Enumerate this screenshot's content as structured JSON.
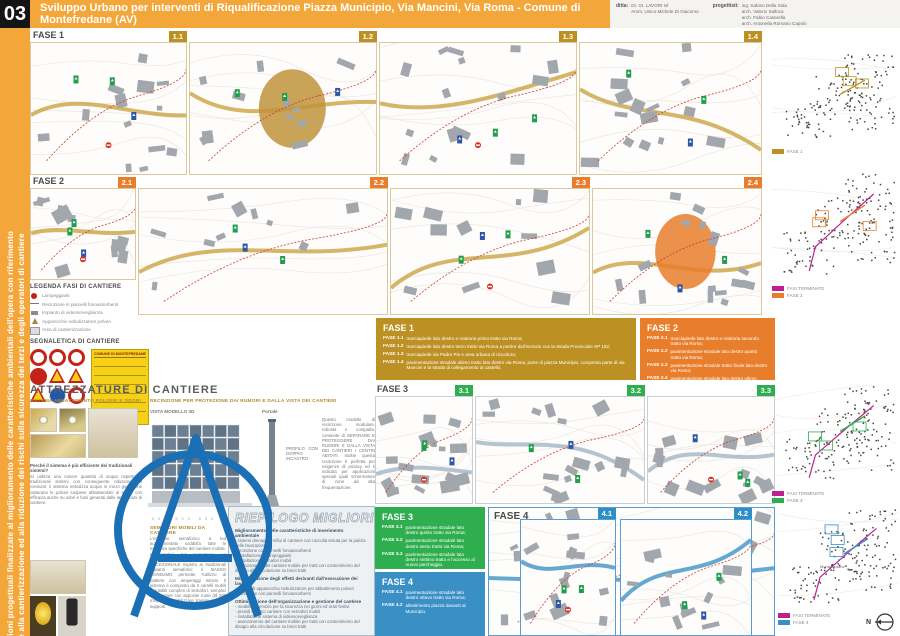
{
  "header": {
    "sheet_number": "03",
    "title": "Sviluppo Urbano per interventi di Riqualificazione Piazza Municipio, Via Mancini, Via Roma - Comune di Montefredane (AV)",
    "ditta_label": "ditta:",
    "ditta_lines": [
      "DI. GI. LAVORI srl",
      "Amm. Unico Michele Di Giacomo"
    ],
    "progettisti_label": "progettisti:",
    "progettisti_lines": [
      "ing. Sabino Della Sala",
      "arch. Valerio Salloca",
      "arch. Fabio Casarella",
      "arch. Antonella Romano Capolo"
    ]
  },
  "sidebar": {
    "line1": "Soluzioni progettuali finalizzate al miglioramento delle caratteristiche ambientali dell'opera con riferimento",
    "line2": "anche alla cantierizzazione ed alla riduzione dei rischi sulla sicurezza dei terzi e degli operatori di cantiere"
  },
  "rows": {
    "fase1": {
      "label": "FASE 1",
      "badges": [
        "1.1",
        "1.2",
        "1.3",
        "1.4"
      ]
    },
    "fase2": {
      "label": "FASE 2",
      "badges": [
        "2.1",
        "2.2",
        "2.3",
        "2.4"
      ]
    },
    "fase3": {
      "label": "FASE 3",
      "badges": [
        "3.1",
        "3.2",
        "3.3"
      ]
    },
    "fase4": {
      "label": "FASE 4",
      "badges": [
        "4.1",
        "4.2"
      ]
    }
  },
  "legend": {
    "title": "LEGENDA FASI DI CANTIERE",
    "items": [
      {
        "icon": "lamp",
        "label": "Lampeggianti"
      },
      {
        "icon": "fence",
        "label": "Recinzione in pannelli fonoassorbenti"
      },
      {
        "icon": "camera",
        "label": "Impianto di videosorveglianza"
      },
      {
        "icon": "fog",
        "label": "Apparecchio nebulizzatore polveri"
      },
      {
        "icon": "area",
        "label": "Area di cantierizzazione"
      }
    ],
    "segnaletica_title": "SEGNALETICA DI CANTIERE",
    "sign_board_title": "COMUNE DI MONTEFREDANE"
  },
  "fase_boxes": {
    "fase1": {
      "title": "FASE 1",
      "items": [
        {
          "code": "FASE 1.1",
          "text": "marciapiede lato destro e rotatoria primo tratto via Roma;"
        },
        {
          "code": "FASE 1.2",
          "text": "marciapiede lato destro terzo tratto via Roma a partire dall'incrocio con la strada Provinciale SP 192;"
        },
        {
          "code": "FASE 1.3",
          "text": "marciapiede via Padre Pio e area urbana di ricucitura;"
        },
        {
          "code": "FASE 1.4",
          "text": "pavimentazione stradale ultimo tratto lato destro via Roma, parte di piazza Municipio, compresa parte di via Mancini e la strada di collegamento al castello."
        }
      ]
    },
    "fase2": {
      "title": "FASE 2",
      "items": [
        {
          "code": "FASE 2.1",
          "text": "marciapiede lato destro e rotatoria secondo tratto via Roma;"
        },
        {
          "code": "FASE 2.2",
          "text": "pavimentazione stradale lato destro quarto tratto via Roma;"
        },
        {
          "code": "FASE 2.3",
          "text": "pavimentazione stradale tratto finale lato destro via Roma;"
        },
        {
          "code": "FASE 2.4",
          "text": "pavimentazione stradale lato destro ultimo tratto via Roma, seconda parte di piazza Municipio e rotatoria, in quanto potranno gli automezzi raggiungere via Mancini."
        }
      ]
    },
    "fase3": {
      "title": "FASE 3",
      "items": [
        {
          "code": "FASE 3.1",
          "text": "pavimentazione stradale lato destro quinto tratto via Roma;"
        },
        {
          "code": "FASE 3.2",
          "text": "pavimentazione stradale lato destro sesto tratto via Roma;"
        },
        {
          "code": "FASE 3.3",
          "text": "pavimentazione stradale lato destro settimo tratto e l'accesso al nuovo parcheggio."
        }
      ]
    },
    "fase4": {
      "title": "FASE 4",
      "items": [
        {
          "code": "FASE 4.1",
          "text": "pavimentazione stradale lato destro ottavo tratto via Roma;"
        },
        {
          "code": "FASE 4.2",
          "text": "allestimento piazza davanti al Municipio."
        }
      ]
    }
  },
  "attrezzature": {
    "title": "ATTREZZATURE DI CANTIERE",
    "polveri_title": "SISTEMA ABBATTIMENTO POLVERI E ODORI",
    "polveri_question": "Perché il sistema è più efficiente dei tradizionali sistemi?",
    "polveri_text": "Si utilizza una minore quantità di acqua rispetto ai tradizionali sistemi con conseguente riduzione dei consumi; il sistema nebulizza acqua in micro gocce che catturano le polveri sospese abbattendole al suolo, con efficacia anche su odori e fumi generati dalle lavorazioni di cantiere.",
    "recinzione_title": "RECINZIONE PER PROTEZIONE DAI RUMORI E DALLA VISTA DEI CANTIERI",
    "vista_label": "VISTA MODELLO 3D",
    "portale_label": "Portale",
    "profilo_label": "PROFILO CON DOPPIO INCASTRO",
    "dims": "500  500  500",
    "recinzione_text": "Questo modello di recinzione modulare, robusta e compatta, consente di SEPARARE E PROTEGGERE DAI RUMORI E DALLA VISTA DEI CANTIERI I CENTRI ABITATI. Inoltre questa recinzione è perfetta per esigenze di privacy ed è indicata per applicazioni speciali quali schermature di zone ad alta frequentazione.",
    "semafori_title": "SEMAFORI MOBILI DA CANTIERE",
    "semafori_text": "L'impianto semaforico a led autoalimentato soddisfa tutte le esigenze specifiche del cantiere mobile. I semafori led permettono un RISPARMIO ENERGETICO ECCEZIONALE rispetto ai tradizionali impianti semaforici: il BASSO CONSUMO permette l'utilizzo di batterie con amperaggi minimi. Il sistema è composto da 2 carrelli mobili regolabili completi di semafori, semplici da spostare con apposite ruote (Ø 200 mm) e da stabilizzare tramite appositi supporti."
  },
  "riepilogo": {
    "title": "RIEPILOGO MIGLIORIE PROPOSTE",
    "groups": [
      {
        "heading": "Miglioramento delle caratteristiche di inserimento ambientale",
        "items": [
          "sistemi drenaggio reflui di cantiere con raccolta tenuta per la pulizia delle lavorazioni",
          "recinzione con pannelli fonoassorbenti",
          "installazione di lampeggianti",
          "installazione semafori mobili",
          "avanzamento del cantiere mobile per tratti con contenimento del disagio alla circolazione su brevi tratti"
        ]
      },
      {
        "heading": "Minimizzazione degli effetti derivanti dall'esecuzione dei lavori",
        "items": [
          "utilizzo di apparecchio nebulizzatore per abbattimento polveri",
          "recinzione con pannelli fonoassorbenti"
        ]
      },
      {
        "heading": "Ottimizzazione dell'organizzazione e gestione del cantiere",
        "items": [
          "modelli di servizio per la sicurezza nei giorni ed orari festivi",
          "presidi logistici cantiere con semafori mobili",
          "installazione sistema di videosorveglianza",
          "avanzamento del cantiere mobile per tratti con contenimento del disagio alla circolazione su brevi tratti"
        ]
      }
    ]
  },
  "minimaps": [
    {
      "legend": [
        {
          "label": "FASE 1",
          "color": "#BD9023"
        }
      ]
    },
    {
      "legend": [
        {
          "label": "FASI TERMINATE",
          "color": "#C0208F"
        },
        {
          "label": "FASE 2",
          "color": "#E87E2B"
        }
      ]
    },
    {
      "legend": [
        {
          "label": "FASI TERMINATE",
          "color": "#C0208F"
        },
        {
          "label": "FASE 3",
          "color": "#2EAE4E"
        }
      ]
    },
    {
      "legend": [
        {
          "label": "FASI TERMINATE",
          "color": "#C0208F"
        },
        {
          "label": "FASE 4",
          "color": "#3A8FC5"
        }
      ],
      "place_label": "Montefredane"
    }
  ],
  "north_label": "N",
  "colors": {
    "accent_orange": "#F3A73B",
    "gold": "#BD9023",
    "orange": "#E87E2B",
    "green": "#2EAE4E",
    "blue": "#2E8FC6",
    "magenta": "#C0208F"
  }
}
